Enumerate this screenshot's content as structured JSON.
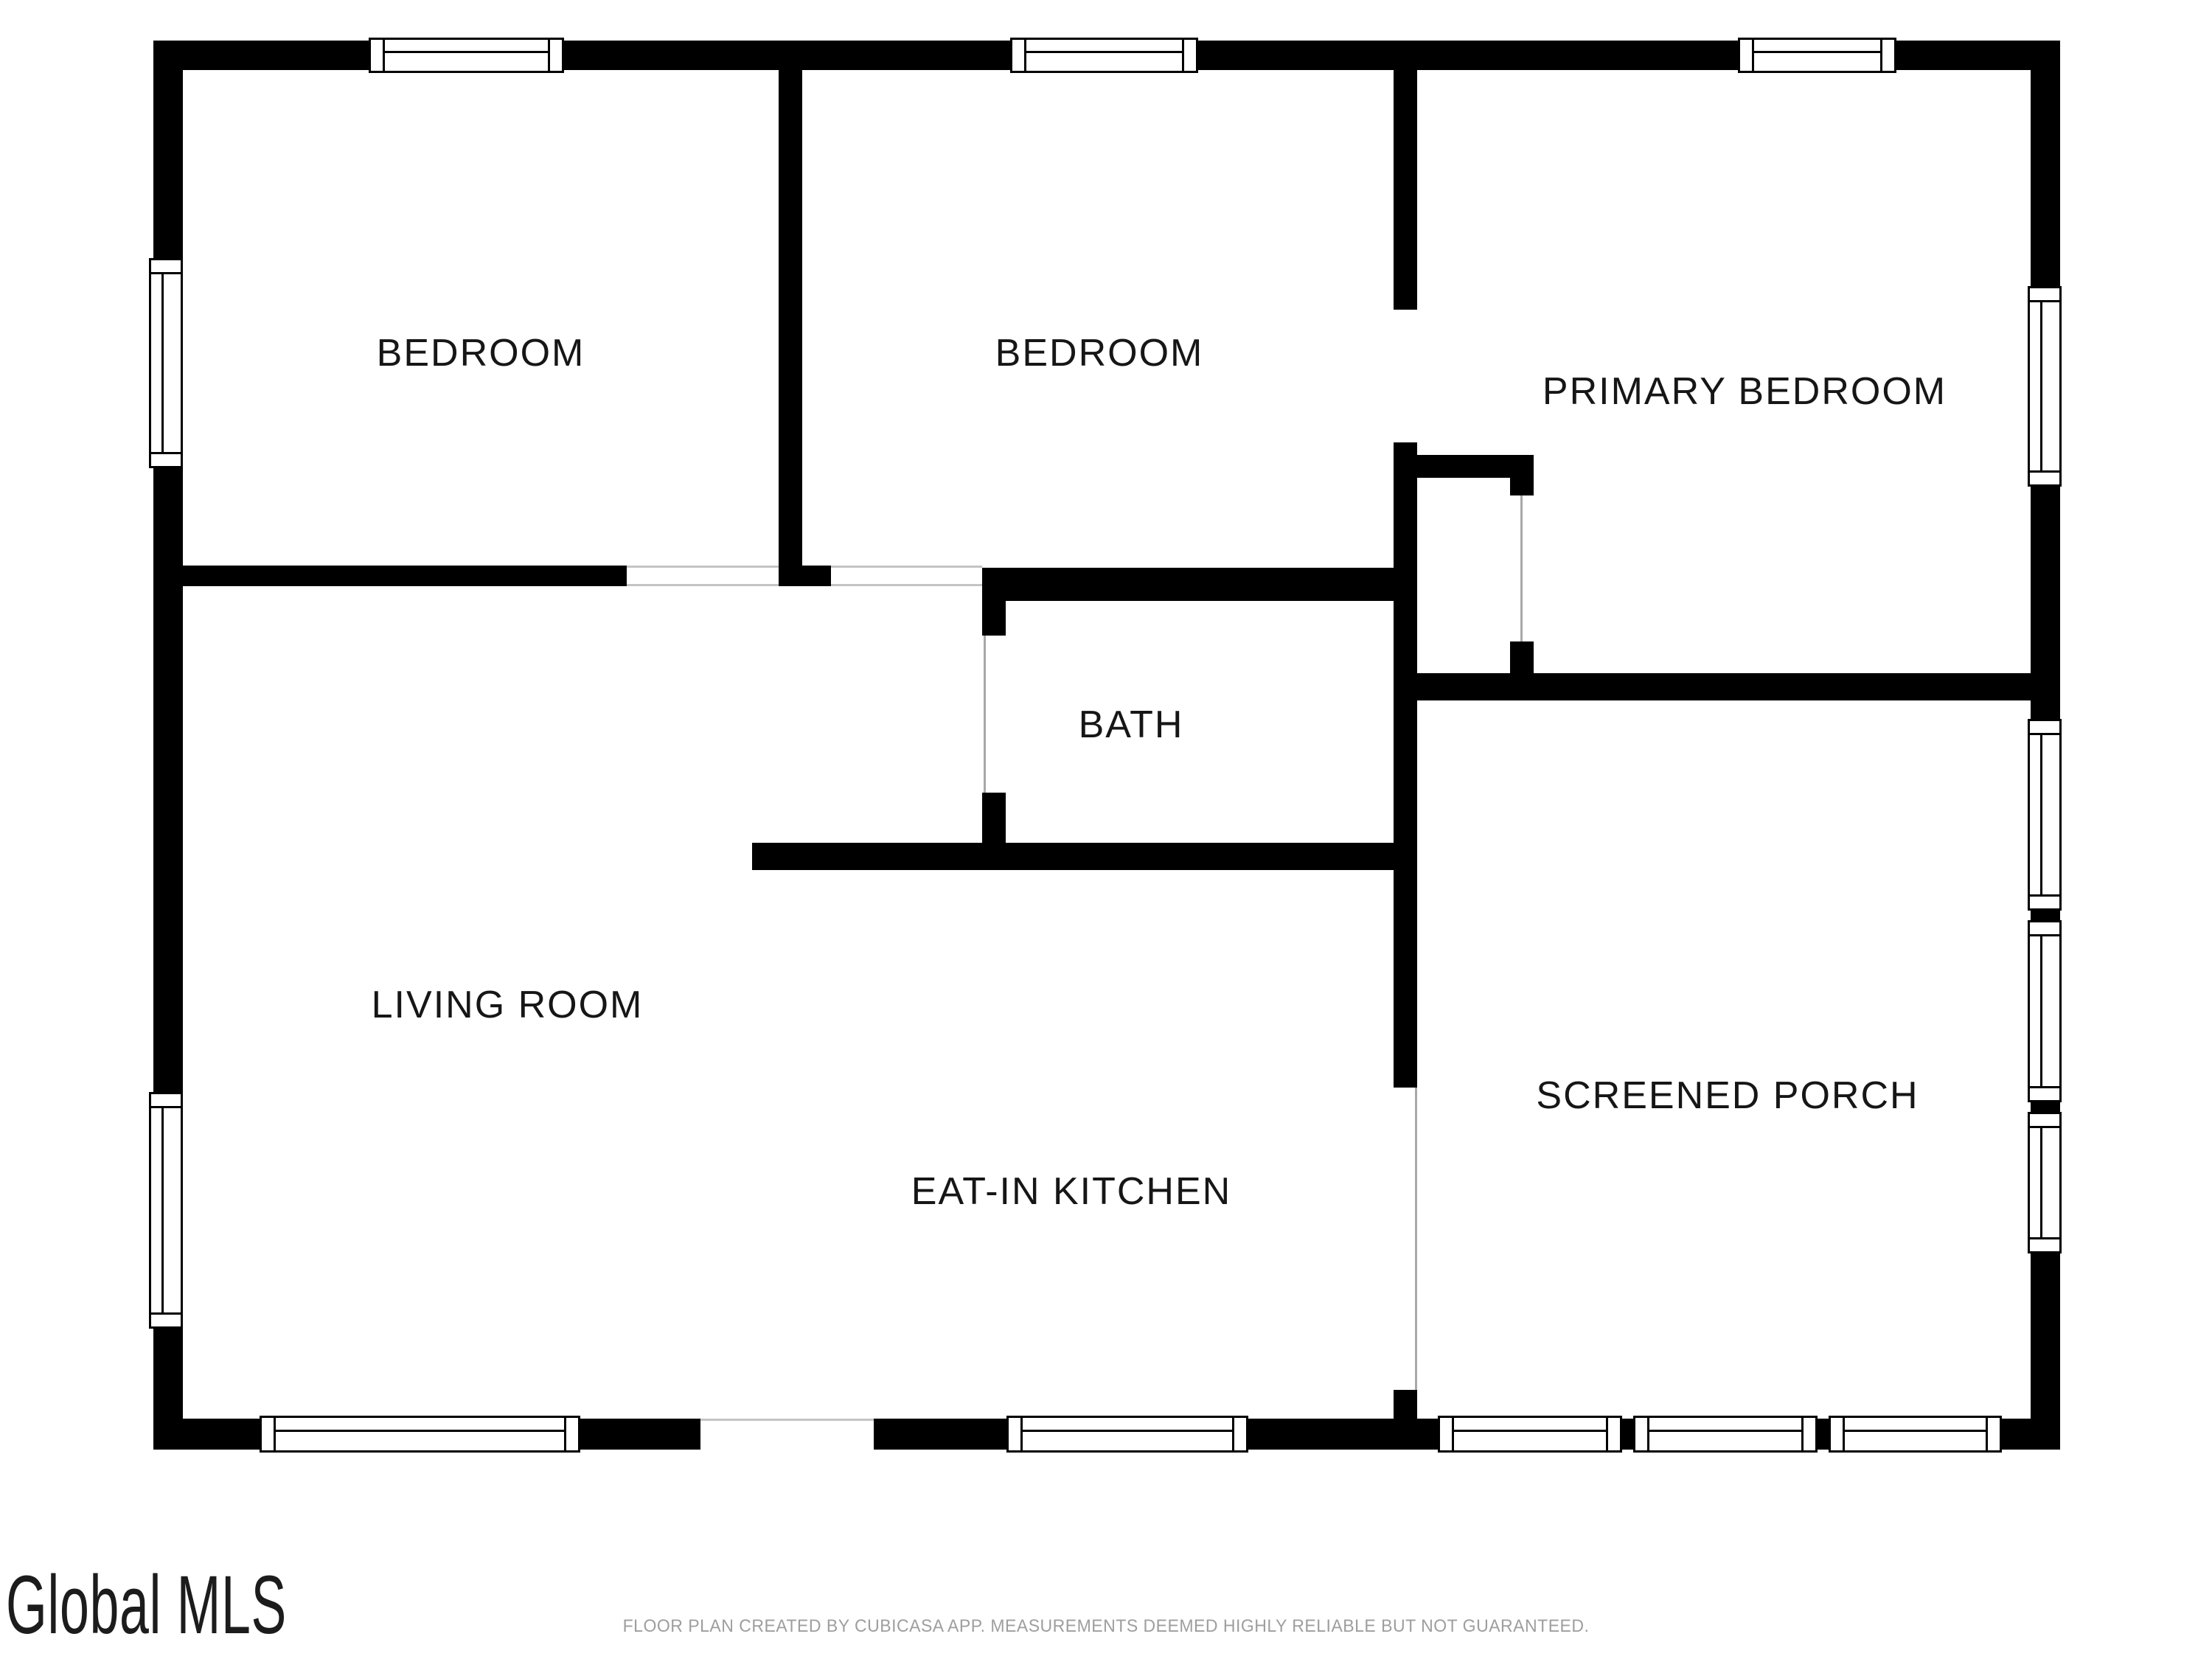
{
  "watermark": {
    "text": "Global MLS"
  },
  "footer": {
    "text": "FLOOR PLAN CREATED BY CUBICASA APP. MEASUREMENTS DEEMED HIGHLY RELIABLE BUT NOT GUARANTEED."
  },
  "rooms": [
    {
      "label": "BEDROOM"
    },
    {
      "label": "BEDROOM"
    },
    {
      "label": "PRIMARY BEDROOM"
    },
    {
      "label": "BATH"
    },
    {
      "label": "LIVING ROOM"
    },
    {
      "label": "EAT-IN KITCHEN"
    },
    {
      "label": "SCREENED PORCH"
    }
  ],
  "colors": {
    "wall": "#000000",
    "door_line": "#a8a8a8",
    "opening_hairline": "#c4c4c4",
    "label_text": "#161616",
    "footer_text": "#9e9e9e"
  }
}
